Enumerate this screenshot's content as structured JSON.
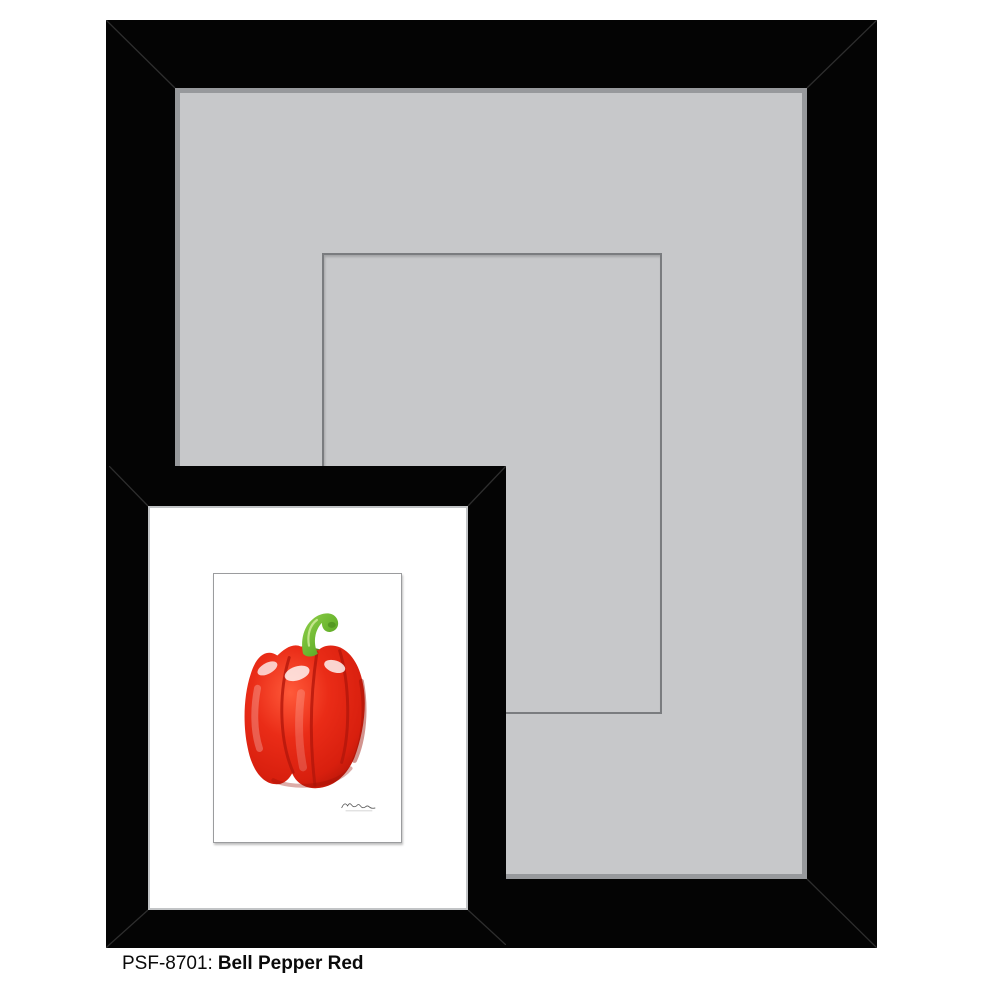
{
  "caption": {
    "sku": "PSF-8701:",
    "title": "Bell Pepper Red"
  },
  "large_frame": {
    "description": "black picture frame with gray mat and marked mat opening",
    "frame_color": "#040404",
    "mat_color": "#c7c8ca",
    "mat_bevel_color": "#97999c",
    "opening_outline_color": "#7a7c7f"
  },
  "small_frame": {
    "description": "black sample frame with white mat holding the print",
    "frame_color": "#040404",
    "mat_color": "#ffffff",
    "mat_bevel_color": "#c2c4c6"
  },
  "artwork": {
    "subject": "red bell pepper with green stem on white ground",
    "signature": "artist-signature",
    "colors": {
      "pepper_red": "#e63020",
      "pepper_red_dark": "#a81208",
      "pepper_highlight": "#ffffff",
      "stem_green": "#6ab52e",
      "stem_green_dark": "#4c8d1e"
    }
  }
}
